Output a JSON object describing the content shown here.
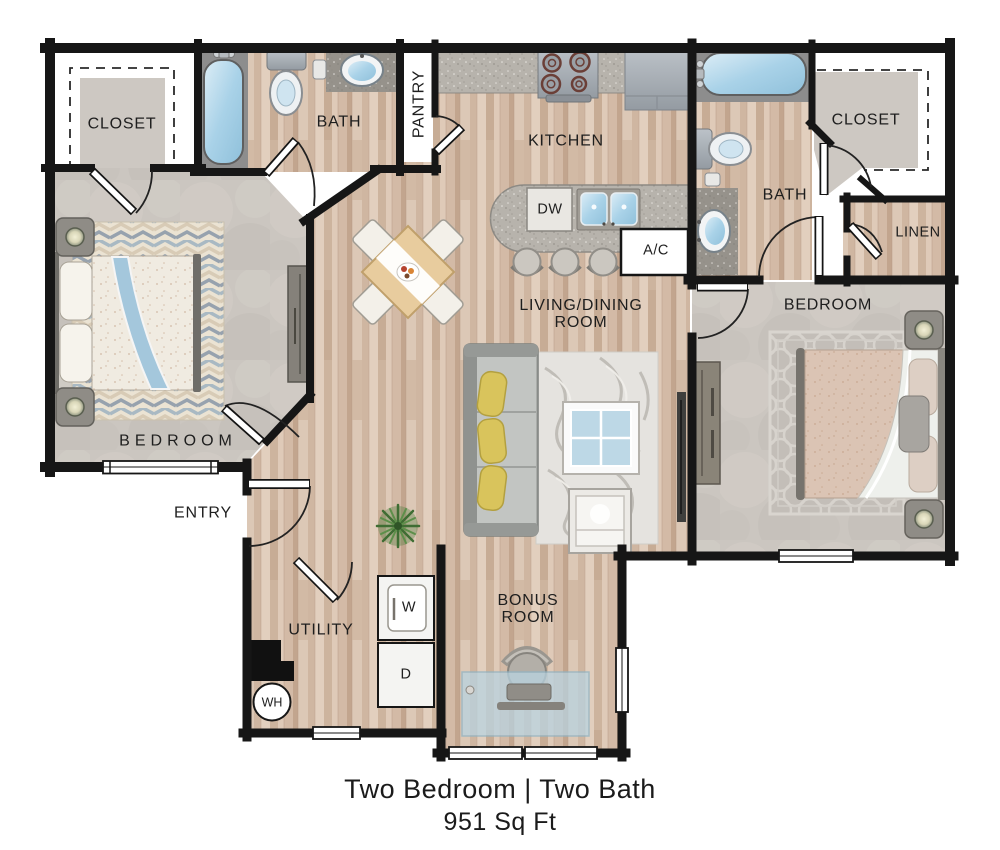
{
  "title": "Two Bedroom Two Bath Floor Plan",
  "caption": {
    "line1": "Two Bedroom | Two Bath",
    "line2": "951 Sq Ft"
  },
  "rooms": {
    "closet_left": "CLOSET",
    "bath_left": "BATH",
    "pantry": "PANTRY",
    "kitchen": "KITCHEN",
    "living_dining": "LIVING/DINING\nROOM",
    "bedroom_left": "BEDROOM",
    "bedroom_right": "BEDROOM",
    "bath_right": "BATH",
    "closet_right": "CLOSET",
    "linen": "LINEN",
    "entry": "ENTRY",
    "utility": "UTILITY",
    "bonus_room": "BONUS\nROOM"
  },
  "fixtures": {
    "dishwasher": "DW",
    "air_conditioner": "A/C",
    "washer": "W",
    "dryer": "D",
    "water_heater": "WH"
  },
  "colors": {
    "wall": "#161616",
    "wood_floor": "#d8c2b0",
    "carpet": "#cbc6c0",
    "counter": "#b7b3ac",
    "water": "#a9d2e8",
    "pillow_accent": "#d9c45c",
    "desk_glass": "#b9d3e0"
  }
}
